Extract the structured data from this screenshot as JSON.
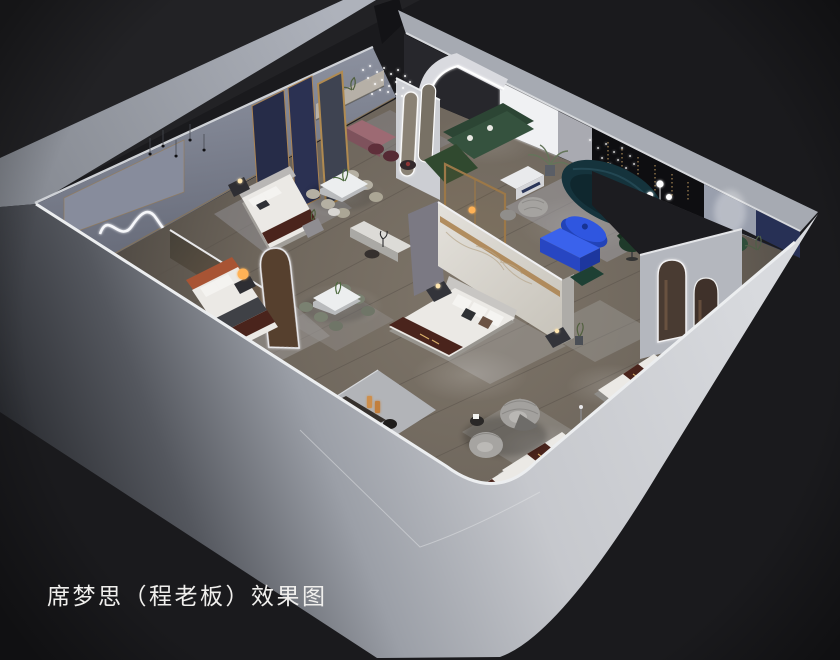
{
  "caption": {
    "text": "席梦思（程老板）效果图"
  },
  "scene_label": "3D cutaway rendering of a mattress showroom floor plan",
  "palette": {
    "bg": "#1a1a1d",
    "bg_soft": "#242428",
    "wall_bright": "#d4d6da",
    "wall_light": "#b8bbc2",
    "wall_mid": "#9aa0ab",
    "wall_inner": "#7d8290",
    "floor_wood": "#6f675e",
    "rug": "#a9a8a6",
    "led": "#f6f7fa",
    "gold": "#ac8452",
    "navy": "#273055",
    "marble": "#dcd9d3",
    "green": "#35523e",
    "teal": "#15333c",
    "blue": "#2f56e0",
    "terracotta": "#a85434",
    "mauve": "#9d6a73",
    "mattress": "#ebe9e5",
    "runner": "#4a241c",
    "amber": "#ffb257"
  }
}
